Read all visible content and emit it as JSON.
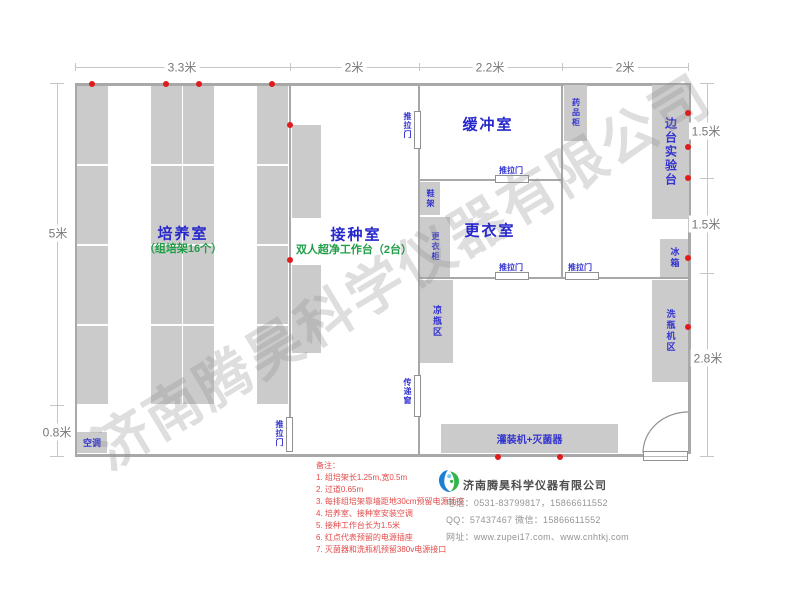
{
  "dimensions": {
    "top": [
      "3.3米",
      "2米",
      "2.2米",
      "2米"
    ],
    "left": [
      "5米",
      "0.8米"
    ],
    "right": [
      "1.5米",
      "1.5米",
      "2.8米"
    ]
  },
  "rooms": {
    "culture": {
      "title": "培养室",
      "subtitle": "（组培架16个）"
    },
    "inoculation": {
      "title": "接种室",
      "subtitle": "双人超净工作台（2台）"
    },
    "buffer": {
      "title": "缓冲室"
    },
    "changing": {
      "title": "更衣室"
    }
  },
  "watermark": "济南腾昊科学仪器有限公司",
  "notes": {
    "title": "备注：",
    "items": [
      "1. 组培架长1.25m,宽0.5m",
      "2. 过道0.65m",
      "3. 每排组培架靠墙距地30cm预留电源插座",
      "4. 培养室、接种室安装空调",
      "5. 接种工作台长为1.5米",
      "6. 红点代表预留的电源插座",
      "7. 灭菌器和洗瓶机预留380v电源接口"
    ]
  },
  "company": {
    "name": "济南腾昊科学仪器有限公司",
    "phone": "电话：0531-83799817，15866611552",
    "qq": "QQ：57437467   微信：15866611552",
    "website": "网址：www.zupei17.com、www.cnhtkj.com"
  },
  "colors": {
    "accent_blue": "#3434cf",
    "accent_green": "#1f9e46",
    "note_red": "#e34a4a",
    "wall_gray": "#a8a8a8",
    "block_gray": "#cbcbcb",
    "dot_red": "#e01b1b",
    "logo_blue": "#1b7fd4",
    "logo_green": "#35b44a"
  },
  "plan": {
    "walls": [
      [
        75,
        83,
        616,
        3
      ],
      [
        75,
        83,
        2,
        373
      ],
      [
        688,
        83,
        3,
        371
      ],
      [
        75,
        454,
        568,
        3
      ],
      [
        289,
        86,
        2,
        331
      ],
      [
        418,
        86,
        2,
        25
      ],
      [
        418,
        149,
        2,
        226
      ],
      [
        418,
        417,
        2,
        37
      ],
      [
        561,
        86,
        2,
        192
      ],
      [
        420,
        179,
        75,
        2
      ],
      [
        529,
        179,
        33,
        2
      ],
      [
        420,
        277,
        75,
        2
      ],
      [
        529,
        277,
        36,
        2
      ],
      [
        599,
        277,
        89,
        2
      ]
    ],
    "dim_ticks": [
      [
        75,
        67,
        614,
        1
      ],
      [
        75,
        63,
        1,
        8
      ],
      [
        290,
        63,
        1,
        8
      ],
      [
        419,
        63,
        1,
        8
      ],
      [
        562,
        63,
        1,
        8
      ],
      [
        688,
        63,
        1,
        8
      ],
      [
        57,
        83,
        1,
        374
      ],
      [
        50,
        83,
        14,
        1
      ],
      [
        50,
        405,
        14,
        1
      ],
      [
        50,
        456,
        14,
        1
      ],
      [
        707,
        83,
        1,
        374
      ],
      [
        700,
        83,
        14,
        1
      ],
      [
        700,
        178,
        14,
        1
      ],
      [
        700,
        273,
        14,
        1
      ],
      [
        700,
        456,
        14,
        1
      ]
    ],
    "blocks": [
      {
        "name": "culture-rack",
        "cls": "rack",
        "x": 77,
        "y": 86,
        "w": 31,
        "h": 319
      },
      {
        "name": "culture-rack",
        "cls": "rack",
        "x": 151,
        "y": 86,
        "w": 31,
        "h": 319
      },
      {
        "name": "culture-rack",
        "cls": "rack",
        "x": 183,
        "y": 86,
        "w": 31,
        "h": 319
      },
      {
        "name": "culture-rack",
        "cls": "rack",
        "x": 257,
        "y": 86,
        "w": 31,
        "h": 319
      },
      {
        "name": "clean-bench",
        "x": 292,
        "y": 125,
        "w": 29,
        "h": 93
      },
      {
        "name": "clean-bench",
        "x": 292,
        "y": 265,
        "w": 29,
        "h": 88
      },
      {
        "name": "shoe-rack",
        "x": 420,
        "y": 182,
        "w": 20,
        "h": 33,
        "label": "鞋架",
        "v": true,
        "fs": 8
      },
      {
        "name": "wardrobe",
        "x": 420,
        "y": 217,
        "w": 30,
        "h": 60,
        "label": "更衣柜",
        "v": true,
        "fs": 8
      },
      {
        "name": "bottle-cooling-area",
        "x": 420,
        "y": 280,
        "w": 33,
        "h": 83,
        "label": "凉瓶区",
        "v": true,
        "fs": 9
      },
      {
        "name": "medicine-cabinet",
        "x": 564,
        "y": 85,
        "w": 23,
        "h": 56,
        "label": "药品柜",
        "v": true,
        "fs": 8
      },
      {
        "name": "side-lab-bench",
        "x": 652,
        "y": 85,
        "w": 37,
        "h": 134,
        "label": "边台实验台",
        "v": true,
        "fs": 12
      },
      {
        "name": "refrigerator",
        "x": 660,
        "y": 239,
        "w": 28,
        "h": 38,
        "label": "冰箱",
        "v": true,
        "fs": 9
      },
      {
        "name": "bottle-washer-area",
        "x": 652,
        "y": 280,
        "w": 36,
        "h": 102,
        "label": "洗瓶机区",
        "v": true,
        "fs": 9
      },
      {
        "name": "filling-machine-sterilizer",
        "x": 441,
        "y": 424,
        "w": 177,
        "h": 29,
        "label": "灌装机+灭菌器",
        "fs": 10
      },
      {
        "name": "air-conditioner",
        "x": 77,
        "y": 432,
        "w": 30,
        "h": 21,
        "label": "空调",
        "fs": 9
      }
    ],
    "doors": [
      {
        "name": "sliding-door",
        "x": 414,
        "y": 111,
        "w": 7,
        "h": 38,
        "label": "推拉门",
        "v": true,
        "lx": 402,
        "ly": 112
      },
      {
        "name": "sliding-door",
        "x": 495,
        "y": 175,
        "w": 34,
        "h": 8,
        "label": "推拉门",
        "lx": 499,
        "ly": 165
      },
      {
        "name": "sliding-door",
        "x": 495,
        "y": 272,
        "w": 34,
        "h": 8,
        "label": "推拉门",
        "lx": 499,
        "ly": 262
      },
      {
        "name": "sliding-door",
        "x": 565,
        "y": 272,
        "w": 34,
        "h": 8,
        "label": "推拉门",
        "lx": 568,
        "ly": 262
      },
      {
        "name": "sliding-door",
        "x": 286,
        "y": 417,
        "w": 7,
        "h": 35,
        "label": "推拉门",
        "v": true,
        "lx": 274,
        "ly": 420
      },
      {
        "name": "transfer-window",
        "x": 414,
        "y": 375,
        "w": 7,
        "h": 42,
        "label": "传递窗",
        "v": true,
        "lx": 402,
        "ly": 378
      }
    ],
    "dots": [
      [
        92,
        84
      ],
      [
        166,
        84
      ],
      [
        199,
        84
      ],
      [
        272,
        84
      ],
      [
        290,
        125
      ],
      [
        290,
        260
      ],
      [
        688,
        113
      ],
      [
        688,
        147
      ],
      [
        688,
        178
      ],
      [
        688,
        258
      ],
      [
        688,
        327
      ],
      [
        498,
        457
      ],
      [
        560,
        457
      ]
    ]
  }
}
